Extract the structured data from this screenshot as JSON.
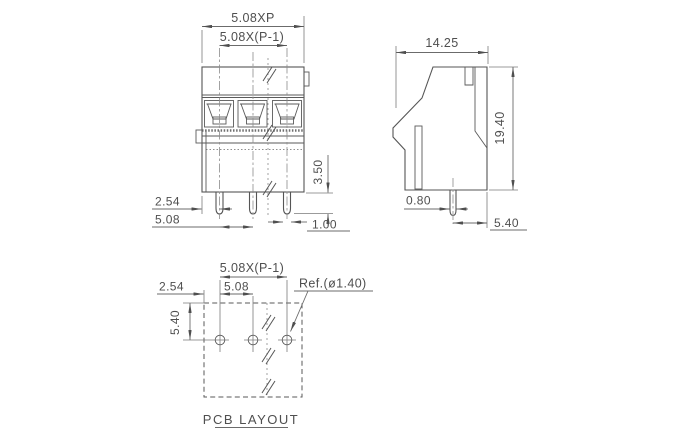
{
  "front_view": {
    "dims": {
      "overall_pitch": "5.08XP",
      "pin_span": "5.08X(P-1)",
      "edge_to_pin": "2.54",
      "pitch": "5.08",
      "pin_protrusion": "3.50",
      "pin_width": "1.00"
    }
  },
  "side_view": {
    "dims": {
      "depth": "14.25",
      "height": "19.40",
      "pin_thickness": "0.80",
      "pin_to_front": "5.40"
    }
  },
  "pcb_layout": {
    "caption": "PCB LAYOUT",
    "dims": {
      "pad_span": "5.08X(P-1)",
      "edge_to_pad": "2.54",
      "pad_pitch": "5.08",
      "edge_to_row": "5.40",
      "hole_ref": "Ref.(ø1.40)"
    }
  }
}
